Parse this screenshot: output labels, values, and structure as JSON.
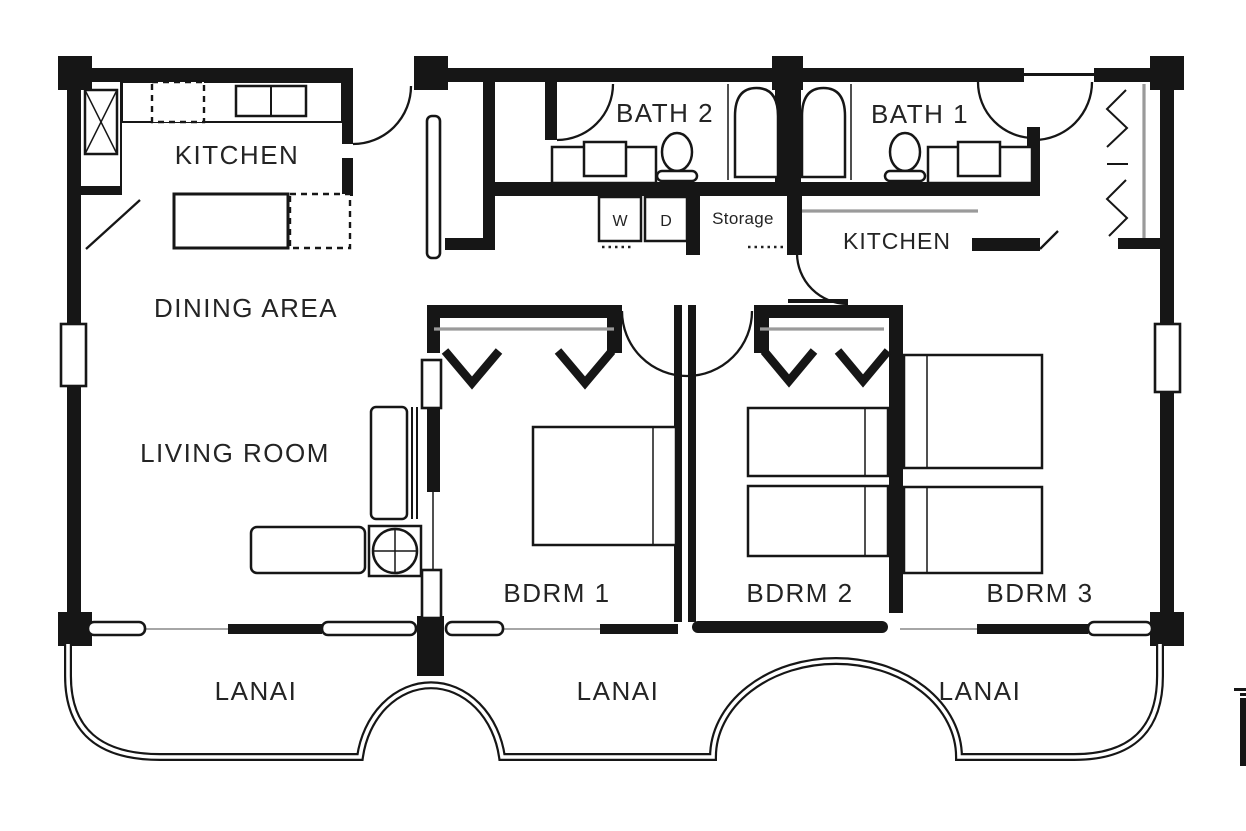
{
  "plan": {
    "type": "apartment-floor-plan",
    "labels": {
      "kitchen_left": "KITCHEN",
      "dining": "DINING AREA",
      "living": "LIVING ROOM",
      "bath2": "BATH 2",
      "bath1": "BATH 1",
      "kitchen_right": "KITCHEN",
      "washer": "W",
      "dryer": "D",
      "storage": "Storage",
      "bdrm1": "BDRM 1",
      "bdrm2": "BDRM 2",
      "bdrm3": "BDRM 3",
      "lanai1": "LANAI",
      "lanai2": "LANAI",
      "lanai3": "LANAI"
    },
    "colors": {
      "wall": "#161616",
      "text": "#242424",
      "closet_rod_gray": "#9a9a9a",
      "background": "#ffffff"
    }
  }
}
